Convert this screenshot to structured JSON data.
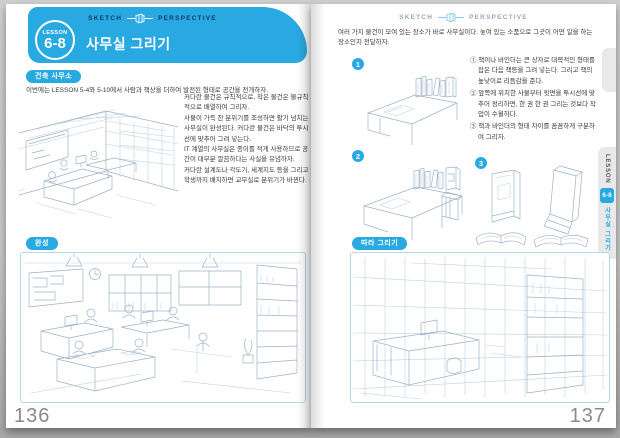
{
  "page_left": {
    "header": {
      "left": "SKETCH",
      "right": "PERSPECTIVE"
    },
    "lesson_badge": {
      "label": "LESSON",
      "number": "6-8"
    },
    "title": "사무실 그리기",
    "section_badge": "건축 사무소",
    "intro": "이번에는 LESSON 5-4와 5-10에서 사람과 책상을 더하여 발전된 형태로 공간을 전개하자.",
    "body_paragraphs": [
      "커다란 물건은 규칙적으로, 작은 물건은 불규칙적으로 배열하여 그리자.",
      "사물이 가득 찬 분위기를 조성하면 활기 넘치는 사무실이 완성된다. 커다란 물건은 바닥의 투시선에 맞추어 그려 넣는다.",
      "IT 계열의 사무실은 종이를 적게 사용하므로 공간이 대부분 깔끔하다는 사실을 유념하자.",
      "커다란 설계도나 각도기, 세계지도 등을 그리고 학생까지 배치하면 교무실로 분위기가 바뀐다."
    ],
    "complete_badge": "완성",
    "page_number": "136"
  },
  "page_right": {
    "header": {
      "left": "SKETCH",
      "right": "PERSPECTIVE"
    },
    "intro": "여러 가지 물건이 모여 있는 장소가 바로 사무실이다. 놓여 있는 소품으로 그곳이 어떤 일을 하는 장소인지 전달하자.",
    "steps": [
      {
        "number": "1"
      },
      {
        "number": "2"
      },
      {
        "number": "3"
      }
    ],
    "notes": [
      "① 책이나 바인더는 큰 상자로 대략적인 형태를 잡은 다음 책등을 그려 넣는다. 그리고 책의 높낮이로 리듬감을 준다.",
      "② 앞쪽에 위치한 사물부터 윗면을 투시선에 맞추어 정리하면, 한 권 한 권 그리는 것보다 작업이 수월하다.",
      "③ 책과 바인더의 형태 차이를 꼼꼼하게 구분하여 그리자."
    ],
    "follow_badge": "따라 그리기",
    "side_tab": {
      "label": "LESSON",
      "number": "6-8",
      "title": "사무실 그리기"
    },
    "page_number": "137"
  },
  "colors": {
    "accent_blue": "#29a9e2",
    "header_navy": "#0d3c66",
    "header_gray": "#9aa8b8",
    "sketch_line": "#9db2c9",
    "tab_bg": "#e8e8ea",
    "page_number_gray": "#8a8a8a"
  }
}
